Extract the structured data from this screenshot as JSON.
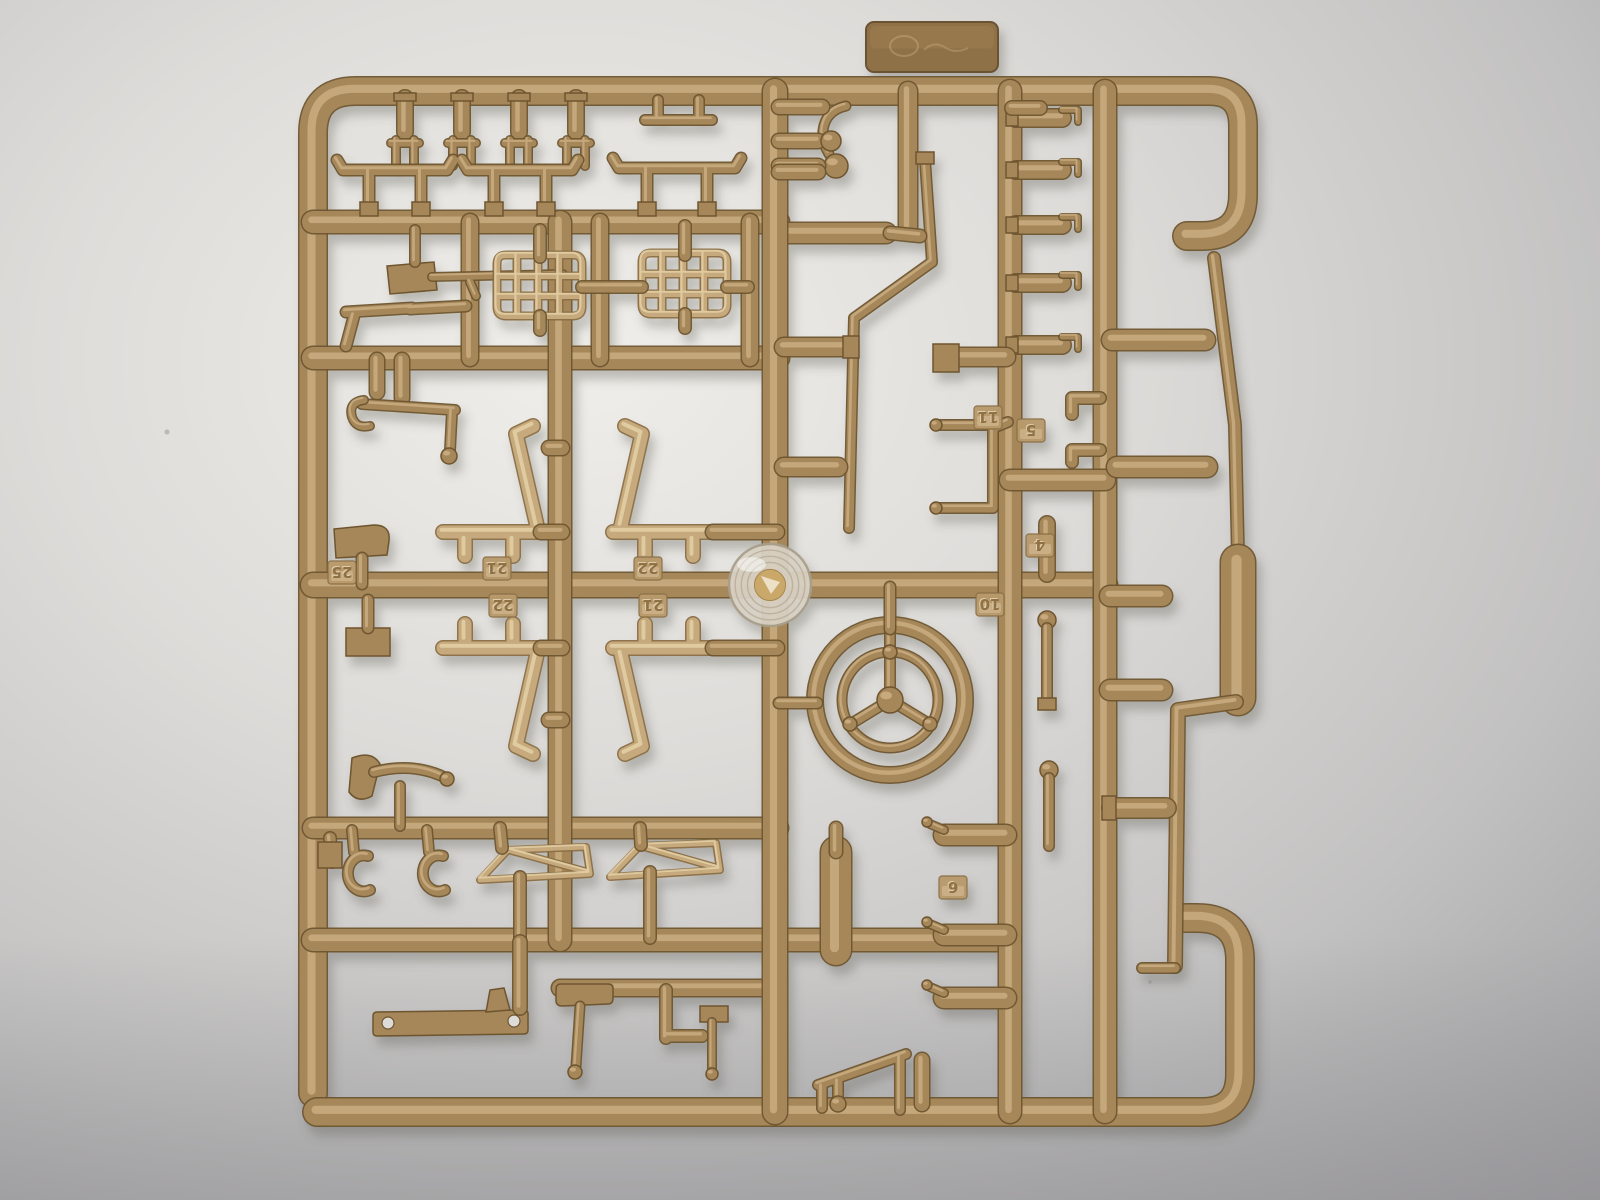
{
  "photo": {
    "subject": "tan plastic model kit sprue (injection-molded parts tree) photographed on gray-white paper",
    "background": {
      "center": "#f0eeea",
      "mid": "#dedcd9",
      "edge": "#c2c1c1",
      "corner": "#9e9da0",
      "bottom_shade": "#8e8d90"
    },
    "plastic": {
      "base": "#a5875a",
      "dark": "#6e552f",
      "highlight": "#cfb286",
      "light_base": "#c6aa7d",
      "light_dark": "#8a6e45",
      "light_highlight": "#e8d5ae",
      "tag_face": "#b89a6c",
      "tag_edge": "#8a6f45"
    },
    "hub": {
      "ring_face": "#d9d2c5",
      "ring_edge": "#a89e8a",
      "ring_lines": "#b9af9b",
      "center_gold": "#c9a86b",
      "glint": "#f2ead6"
    },
    "shadow": {
      "color": "#5f5e54",
      "opacity": 0.35,
      "dx": 5,
      "dy": 9,
      "blur": 5
    }
  },
  "sprue": {
    "part_numbers_visible": [
      "25",
      "21",
      "22",
      "22",
      "21",
      "11",
      "5",
      "4",
      "10",
      "6"
    ],
    "tags": [
      {
        "label": "25",
        "x": 342,
        "y": 572
      },
      {
        "label": "21",
        "x": 497,
        "y": 568
      },
      {
        "label": "22",
        "x": 503,
        "y": 605
      },
      {
        "label": "22",
        "x": 648,
        "y": 568
      },
      {
        "label": "21",
        "x": 653,
        "y": 605
      },
      {
        "label": "11",
        "x": 988,
        "y": 417
      },
      {
        "label": "5",
        "x": 1031,
        "y": 430
      },
      {
        "label": "4",
        "x": 1040,
        "y": 545
      },
      {
        "label": "10",
        "x": 990,
        "y": 604
      },
      {
        "label": "6",
        "x": 953,
        "y": 887
      }
    ],
    "tab": {
      "x": 866,
      "y": 22,
      "w": 132,
      "h": 50,
      "mark": "embossed-illegible"
    },
    "specks": [
      {
        "x": 167,
        "y": 432,
        "r": 2.5
      },
      {
        "x": 1183,
        "y": 337,
        "r": 2
      },
      {
        "x": 1150,
        "y": 982,
        "r": 1.8
      }
    ],
    "elements": [
      {
        "n": "tab-plate",
        "t": "tab"
      },
      {
        "n": "frame-left-top",
        "t": "rod",
        "w": 27,
        "d": "M313,1093 L313,133 Q313,91 356,91 L1209,91 Q1243,91 1243,126 L1243,194 Q1243,236 1202,236 L1187,236"
      },
      {
        "n": "frame-bottom",
        "t": "rod",
        "w": 27,
        "d": "M317,1112 L1202,1112 Q1240,1112 1240,1074 L1240,960 Q1240,918 1197,918 L1186,918"
      },
      {
        "n": "right-rail-thin",
        "t": "rod",
        "w": 11,
        "d": "M1214,258 L1235,425 L1238,556"
      },
      {
        "n": "right-rail-pad",
        "t": "rod",
        "w": 34,
        "d": "M1238,562 L1238,698"
      },
      {
        "n": "right-rail-lower",
        "t": "rod",
        "w": 13,
        "d": "M1236,702 L1178,710 L1175,966"
      },
      {
        "n": "right-rail-gate",
        "t": "rod",
        "w": 9,
        "d": "M1142,968 L1175,968"
      },
      {
        "n": "runner-h-222",
        "t": "rod",
        "w": 22,
        "d": "M313,222 L778,222"
      },
      {
        "n": "runner-h-233",
        "t": "rod",
        "w": 20,
        "d": "M775,233 L886,233"
      },
      {
        "n": "runner-h-358",
        "t": "rod",
        "w": 22,
        "d": "M313,358 L778,358"
      },
      {
        "n": "runner-h-585",
        "t": "rod",
        "w": 24,
        "d": "M313,585 L1105,585"
      },
      {
        "n": "runner-h-828",
        "t": "rod",
        "w": 20,
        "d": "M313,828 L778,828"
      },
      {
        "n": "runner-h-940",
        "t": "rod",
        "w": 22,
        "d": "M313,940 L1010,940"
      },
      {
        "n": "runner-h-988",
        "t": "rod",
        "w": 16,
        "d": "M560,988 L770,988"
      },
      {
        "n": "runner-v-560",
        "t": "rod",
        "w": 22,
        "d": "M560,222 L560,940"
      },
      {
        "n": "runner-v-775",
        "t": "rod",
        "w": 24,
        "d": "M775,91 L775,1112"
      },
      {
        "n": "runner-v-908",
        "t": "rod",
        "w": 18,
        "d": "M908,91 L908,228"
      },
      {
        "n": "runner-v-1010",
        "t": "rod",
        "w": 22,
        "d": "M1010,91 L1010,1112"
      },
      {
        "n": "runner-v-1105",
        "t": "rod",
        "w": 22,
        "d": "M1105,91 L1105,1112"
      },
      {
        "n": "runner-bridge-480",
        "t": "rod",
        "w": 20,
        "d": "M1010,480 L1105,480"
      },
      {
        "n": "runner-v-470",
        "t": "rod",
        "w": 16,
        "d": "M470,222 L470,358"
      },
      {
        "n": "runner-v-600",
        "t": "rod",
        "w": 16,
        "d": "M600,222 L600,358"
      },
      {
        "n": "runner-v-750",
        "t": "rod",
        "w": 16,
        "d": "M750,222 L750,358"
      },
      {
        "n": "top-plugs",
        "t": "rod",
        "w": 15,
        "d": "M405,98 L405,132 M462,98 L462,132 M519,98 L519,132 M576,98 L576,132"
      },
      {
        "n": "top-plug-caps",
        "t": "fill",
        "d": "M394,93 h22 v8 h-22 Z M451,93 h22 v8 h-22 Z M508,93 h22 v8 h-22 Z M565,93 h22 v8 h-22 Z"
      },
      {
        "n": "top-forks",
        "t": "rod",
        "w": 7,
        "d": "M396,140 L396,166 M414,140 L414,166 M391,143 L419,143 M453,140 L453,166 M471,140 L471,166 M448,143 L476,143 M510,140 L510,166 M528,140 L528,166 M505,143 L533,143 M567,140 L567,166 M585,140 L585,166 M562,143 L590,143"
      },
      {
        "n": "top-bar-part",
        "t": "rod",
        "w": 9,
        "d": "M645,120 L712,120 M658,100 L658,118 M699,100 L699,118"
      },
      {
        "n": "table-parts",
        "t": "rod",
        "w": 10,
        "d": "M343,170 L337,160 M343,170 L447,170 M447,170 L453,160 M369,170 L369,206 M421,170 L421,206 M468,170 L462,160 M468,170 L572,170 M572,170 L578,160 M494,170 L494,206 M546,170 L546,206 M619,168 L613,158 M619,168 L735,168 M735,168 L741,158 M647,168 L647,206 M707,168 L707,206"
      },
      {
        "n": "table-feet",
        "t": "fill",
        "d": "M360,202 h18 v14 h-18 Z M412,202 h18 v14 h-18 Z M485,202 h18 v14 h-18 Z M537,202 h18 v14 h-18 Z M638,202 h18 v14 h-18 Z M698,202 h18 v14 h-18 Z"
      },
      {
        "n": "rifle-stock",
        "t": "fill",
        "d": "M387,266 L434,262 L437,290 L390,294 Z"
      },
      {
        "n": "rifle-barrel",
        "t": "rod",
        "w": 7,
        "d": "M432,277 L563,274 M470,282 L476,296"
      },
      {
        "n": "rifle-gate",
        "t": "rod",
        "w": 9,
        "d": "M415,230 L415,262"
      },
      {
        "n": "pistol-part",
        "t": "rod",
        "w": 10,
        "d": "M346,312 L412,308 M354,316 L346,346 M410,309 L466,306"
      },
      {
        "n": "grille-left",
        "t": "lrod",
        "w": 6,
        "d": "M506,255 Q497,255 497,264 L497,307 Q497,316 506,316 L573,316 Q582,316 582,307 L582,264 Q582,255 573,255 Z M497,276 L582,276 M497,296 L582,296 M517,255 L517,316 M538,255 L538,316 M559,255 L559,316"
      },
      {
        "n": "grille-right",
        "t": "lrod",
        "w": 6,
        "d": "M651,253 Q642,253 642,262 L642,305 Q642,314 651,314 L718,314 Q727,314 727,305 L727,262 Q727,253 718,253 Z M642,274 L727,274 M642,294 L727,294 M662,253 L662,314 M683,253 L683,314 M704,253 L704,314"
      },
      {
        "n": "grille-gates",
        "t": "rod",
        "w": 11,
        "d": "M540,230 L540,257 M685,226 L685,255 M582,287 L602,287 M604,287 L642,287 M727,287 L748,287 M540,316 L540,330 M685,314 L685,328"
      },
      {
        "n": "jack-gates",
        "t": "rod",
        "w": 14,
        "d": "M377,360 L377,392 M402,360 L402,398"
      },
      {
        "n": "jack-rod",
        "t": "rod",
        "w": 9,
        "d": "M362,404 L455,410 M452,412 L450,450"
      },
      {
        "n": "jack-hook",
        "t": "rod",
        "w": 7,
        "d": "M364,400 q-16,2 -12,17 q4,12 18,9"
      },
      {
        "n": "jack-ball",
        "t": "ball",
        "cx": 449,
        "cy": 456,
        "r": 8
      },
      {
        "n": "seat-upper-left",
        "t": "lrod",
        "w": 13,
        "d": "M443,532 L545,532 M465,540 L465,556 M513,540 L513,556 M537,526 L516,434 M516,434 L533,426"
      },
      {
        "n": "seat-upper-right",
        "t": "lrod",
        "w": 13,
        "d": "M613,532 L715,532 M645,540 L645,556 M693,540 L693,556 M621,526 L642,434 M642,434 L625,426"
      },
      {
        "n": "seat-lower-left",
        "t": "lrod",
        "w": 13,
        "d": "M443,648 L545,648 M465,640 L465,624 M513,640 L513,624 M537,654 L516,746 M516,746 L533,754"
      },
      {
        "n": "seat-lower-right",
        "t": "lrod",
        "w": 13,
        "d": "M613,648 L715,648 M645,640 L645,624 M693,640 L693,624 M621,654 L642,746 M642,746 L625,754"
      },
      {
        "n": "seat-gates",
        "t": "rod",
        "w": 14,
        "d": "M541,532 L562,532 M713,532 L777,532 M541,648 L562,648 M713,648 L777,648 M549,448 L562,448 M549,720 L562,720"
      },
      {
        "n": "paddle-part",
        "t": "fill",
        "d": "M334,529 L374,525 Q391,525 389,541 L387,555 L336,558 Z"
      },
      {
        "n": "paddle-gate",
        "t": "rod",
        "w": 10,
        "d": "M362,558 L362,584"
      },
      {
        "n": "pad-part",
        "t": "fill",
        "d": "M346,628 h44 v28 h-44 Z"
      },
      {
        "n": "pad-gate",
        "t": "rod",
        "w": 10,
        "d": "M368,600 L368,628"
      },
      {
        "n": "horn-bell",
        "t": "fill",
        "d": "M352,758 Q372,750 380,764 L372,796 Q358,804 349,792 Z"
      },
      {
        "n": "horn-tube",
        "t": "rod",
        "w": 9,
        "d": "M374,772 Q412,762 444,777 M400,786 L400,826"
      },
      {
        "n": "horn-tip",
        "t": "ball",
        "cx": 447,
        "cy": 779,
        "r": 7
      },
      {
        "n": "c-hooks",
        "t": "rod",
        "w": 9,
        "d": "M368,856 A16,18 0 1 0 370,890 M443,856 A16,18 0 1 0 445,890 M352,830 L354,852 M427,830 L429,852"
      },
      {
        "n": "windshield-frames",
        "t": "lrod",
        "w": 5,
        "d": "M480,880 L508,850 L586,847 L590,874 Z M508,850 L588,872 M610,877 L640,846 L716,843 L720,870 Z M640,846 L718,868"
      },
      {
        "n": "windshield-gates",
        "t": "rod",
        "w": 11,
        "d": "M500,828 L502,848 M640,828 L641,845 M520,877 L520,938 M650,872 L650,938 M330,838 L332,862"
      },
      {
        "n": "gate-pad-left",
        "t": "fill",
        "d": "M318,842 h24 v26 h-24 Z"
      },
      {
        "n": "bracket-bar",
        "t": "fill",
        "d": "M377,1012 Q373,1012 373,1016 L373,1032 Q373,1036 377,1036 L524,1034 Q528,1034 528,1030 L528,1014 Q528,1010 524,1010 Z"
      },
      {
        "n": "bracket-hole-1",
        "t": "hole",
        "cx": 388,
        "cy": 1023,
        "r": 6
      },
      {
        "n": "bracket-hole-2",
        "t": "hole",
        "cx": 514,
        "cy": 1021,
        "r": 6
      },
      {
        "n": "bracket-fin",
        "t": "fill",
        "d": "M490,990 L504,988 L510,1010 L486,1012 Z"
      },
      {
        "n": "bracket-gate",
        "t": "rod",
        "w": 13,
        "d": "M520,942 L520,1008"
      },
      {
        "n": "hammer-head",
        "t": "fill",
        "d": "M560,984 Q556,984 556,990 L556,1000 Q556,1006 562,1006 L608,1004 Q613,1004 613,998 L613,988 Q613,984 608,984 Z"
      },
      {
        "n": "hammer-handle",
        "t": "rod",
        "w": 8,
        "d": "M580,1006 L576,1066"
      },
      {
        "n": "hammer-ball",
        "t": "ball",
        "cx": 575,
        "cy": 1072,
        "r": 7
      },
      {
        "n": "mallet-bracket",
        "t": "rod",
        "w": 11,
        "d": "M666,990 L666,1038 M666,1036 L702,1036"
      },
      {
        "n": "mallet-head",
        "t": "fill",
        "d": "M700,1006 h28 v16 h-28 Z"
      },
      {
        "n": "mallet-shaft",
        "t": "rod",
        "w": 7,
        "d": "M712,1022 L712,1068"
      },
      {
        "n": "mallet-ball",
        "t": "ball",
        "cx": 712,
        "cy": 1074,
        "r": 6
      },
      {
        "n": "mold-hub-disc",
        "t": "hub",
        "cx": 770,
        "cy": 585,
        "r": 41
      },
      {
        "n": "steering-wheel-rim",
        "t": "ring",
        "cx": 890,
        "cy": 700,
        "r": 75,
        "w": 15
      },
      {
        "n": "steering-wheel-inner-ring",
        "t": "ring",
        "cx": 890,
        "cy": 700,
        "r": 48,
        "w": 8
      },
      {
        "n": "steering-wheel-spokes",
        "t": "rod",
        "w": 9,
        "d": "M890,700 L890,627 M890,700 L931,725 M890,700 L849,725"
      },
      {
        "n": "spoke-bump-top",
        "t": "ball",
        "cx": 890,
        "cy": 652,
        "r": 7
      },
      {
        "n": "spoke-bump-right",
        "t": "ball",
        "cx": 930,
        "cy": 724,
        "r": 7
      },
      {
        "n": "spoke-bump-left",
        "t": "ball",
        "cx": 850,
        "cy": 724,
        "r": 7
      },
      {
        "n": "steering-wheel-hub",
        "t": "ball",
        "cx": 890,
        "cy": 700,
        "r": 13
      },
      {
        "n": "wheel-gates",
        "t": "rod",
        "w": 10,
        "d": "M890,587 L890,629 M779,703 L817,703"
      },
      {
        "n": "bent-rod",
        "t": "rod",
        "w": 9,
        "d": "M925,160 L932,262 L854,318 L849,528"
      },
      {
        "n": "bent-rod-gate",
        "t": "fill",
        "d": "M916,152 h18 v12 h-18 Z"
      },
      {
        "n": "bent-rod-stub",
        "t": "rod",
        "w": 12,
        "d": "M890,233 L920,236"
      },
      {
        "n": "ball-lever-arm",
        "t": "rod",
        "w": 8,
        "d": "M846,106 Q820,112 823,142 L829,154"
      },
      {
        "n": "ball-lever-ball",
        "t": "ball",
        "cx": 836,
        "cy": 166,
        "r": 12
      },
      {
        "n": "ball-lever-gate",
        "t": "rod",
        "w": 14,
        "d": "M779,166 L818,166"
      },
      {
        "n": "vb-side-bolts",
        "t": "rod",
        "w": 14,
        "d": "M779,107 L822,107 M779,141 L818,141 M779,172 L818,172"
      },
      {
        "n": "vb-ball-stud",
        "t": "ball",
        "cx": 831,
        "cy": 141,
        "r": 10
      },
      {
        "n": "mid-capsules",
        "t": "rod",
        "w": 18,
        "d": "M784,347 L846,347 M784,467 L838,467"
      },
      {
        "n": "mid-capsule-gate",
        "t": "fill",
        "d": "M843,336 h16 v22 h-16 Z"
      },
      {
        "n": "right-bolt-row",
        "t": "rod",
        "w": 17,
        "d": "M1016,118 L1062,118 M1016,170 L1062,170 M1016,225 L1062,225 M1016,283 L1062,283 M1016,345 L1062,345"
      },
      {
        "n": "right-bolt-gates",
        "t": "fill",
        "d": "M1006,110 h12 v16 h-12 Z M1006,162 h12 v16 h-12 Z M1006,217 h12 v16 h-12 Z M1006,275 h12 v16 h-12 Z M1006,337 h12 v16 h-12 Z"
      },
      {
        "n": "right-bolt-clips",
        "t": "rod",
        "w": 5,
        "d": "M1062,110 L1078,110 L1078,122 M1062,162 L1078,162 L1078,174 M1062,217 L1078,217 L1078,229 M1062,275 L1078,275 L1078,287 M1062,337 L1078,337 L1078,349"
      },
      {
        "n": "gate-capsule-355",
        "t": "rod",
        "w": 18,
        "d": "M958,357 L1006,357"
      },
      {
        "n": "gate-pad-355",
        "t": "fill",
        "d": "M933,344 h26 v28 h-26 Z"
      },
      {
        "n": "cap-top-right",
        "t": "rod",
        "w": 13,
        "d": "M1012,108 L1040,108"
      },
      {
        "n": "grab-handle",
        "t": "rod",
        "w": 9,
        "d": "M993,425 L993,508 M940,425 L993,425 M940,508 L993,508 M993,428 L1008,422"
      },
      {
        "n": "grab-handle-tip-1",
        "t": "ball",
        "cx": 936,
        "cy": 425,
        "r": 6
      },
      {
        "n": "grab-handle-tip-2",
        "t": "ball",
        "cx": 936,
        "cy": 508,
        "r": 6
      },
      {
        "n": "small-brackets-1105",
        "t": "rod",
        "w": 11,
        "d": "M1072,398 L1100,398 M1072,398 L1072,414 M1072,450 L1100,450 M1072,450 L1072,462"
      },
      {
        "n": "right-gate-capsules",
        "t": "rod",
        "w": 20,
        "d": "M1112,340 L1205,340 M1117,467 L1207,467 M1110,596 L1162,596 M1110,690 L1162,690"
      },
      {
        "n": "pin-1047",
        "t": "rod",
        "w": 15,
        "d": "M1047,524 L1047,574"
      },
      {
        "n": "lever-1047-ball",
        "t": "ball",
        "cx": 1047,
        "cy": 620,
        "r": 9
      },
      {
        "n": "lever-1047",
        "t": "rod",
        "w": 9,
        "d": "M1047,628 L1047,700"
      },
      {
        "n": "lever-1047-foot",
        "t": "fill",
        "d": "M1038,698 h18 v12 h-18 Z"
      },
      {
        "n": "lever-1049-ball",
        "t": "ball",
        "cx": 1049,
        "cy": 770,
        "r": 9
      },
      {
        "n": "lever-1049",
        "t": "rod",
        "w": 9,
        "d": "M1049,778 L1049,846"
      },
      {
        "n": "gate-capsule-800",
        "t": "rod",
        "w": 19,
        "d": "M1112,808 L1166,808"
      },
      {
        "n": "gate-pad-800",
        "t": "fill",
        "d": "M1102,796 h14 v24 h-14 Z"
      },
      {
        "n": "valve-capsules",
        "t": "rod",
        "w": 20,
        "d": "M944,835 L1006,835 M944,935 L1006,935 M944,998 L1006,998"
      },
      {
        "n": "valve-spouts",
        "t": "rod",
        "w": 7,
        "d": "M944,830 L930,824 M944,930 L930,924 M944,993 L930,987"
      },
      {
        "n": "valve-spout-ball-1",
        "t": "ball",
        "cx": 927,
        "cy": 822,
        "r": 5
      },
      {
        "n": "valve-spout-ball-2",
        "t": "ball",
        "cx": 927,
        "cy": 922,
        "r": 5
      },
      {
        "n": "valve-spout-ball-3",
        "t": "ball",
        "cx": 927,
        "cy": 985,
        "r": 5
      },
      {
        "n": "cylinder-part",
        "t": "rod",
        "w": 30,
        "d": "M836,852 L836,950"
      },
      {
        "n": "cylinder-gate",
        "t": "rod",
        "w": 12,
        "d": "M836,828 L836,852"
      },
      {
        "n": "seesaw-part",
        "t": "rod",
        "w": 9,
        "d": "M818,1085 L906,1054 M822,1087 L822,1108 M900,1058 L900,1110 M838,1082 L838,1098"
      },
      {
        "n": "seesaw-ball",
        "t": "ball",
        "cx": 838,
        "cy": 1104,
        "r": 8
      },
      {
        "n": "bottom-capsule",
        "t": "rod",
        "w": 14,
        "d": "M922,1060 L922,1104"
      }
    ]
  }
}
